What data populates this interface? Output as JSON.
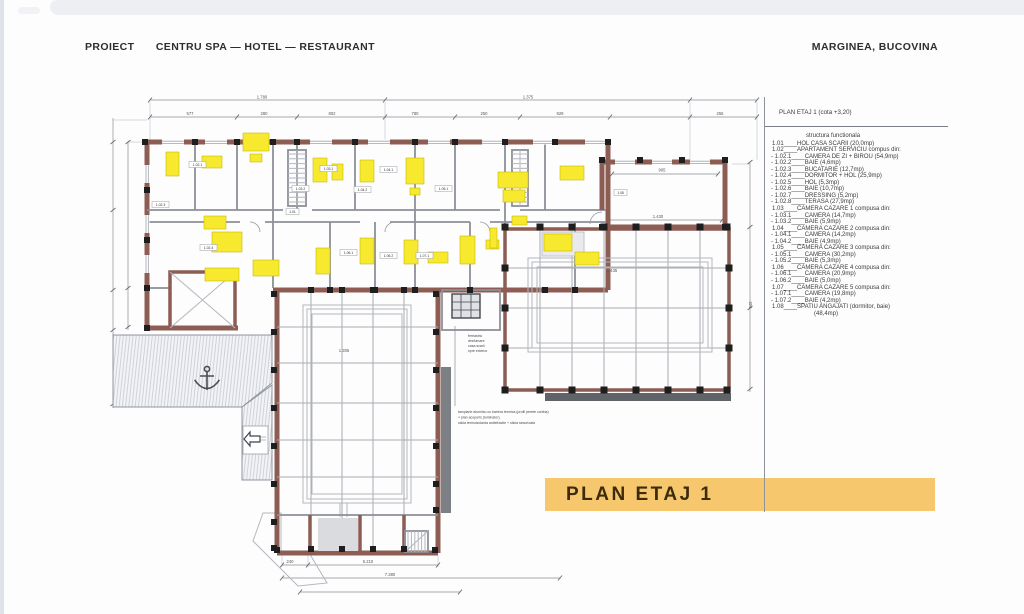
{
  "header": {
    "project_label": "PROIECT",
    "project_title": "CENTRU SPA — HOTEL — RESTAURANT",
    "location": "MARGINEA, BUCOVINA"
  },
  "legend": {
    "title": "PLAN ETAJ 1 (cota +3,20)",
    "subtitle": "structura functionala",
    "items": [
      "1.01____HOL CASA SCARII (20,0mp)",
      "1.02____APARTAMENT SERVICIU compus din:",
      "- 1.02.1____CAMERA DE ZI + BIROU (54,9mp)",
      "- 1.02.2____BAIE (4,6mp)",
      "- 1.02.3____BUCATARIE (12,7mp)",
      "- 1.02.4____DORMITOR + HOL (25,9mp)",
      "- 1.02.5____HOL (5,3mp)",
      "- 1.02.6____BAIE (10,7mp)",
      "- 1.02.7____DRESSING (5,2mp)",
      "- 1.02.8____TERASA (27,9mp)",
      "1.03____CAMERA CAZARE 1 compusa din:",
      "- 1.03.1____CAMERA (14,7mp)",
      "- 1.03.2____BAIE (5,9mp)",
      "1.04____CAMERA CAZARE 2 compusa din:",
      "- 1.04.1____CAMERA (14,2mp)",
      "- 1.04.2____BAIE (4,9mp)",
      "1.05____CAMERA CAZARE 3 compusa din:",
      "- 1.05.1____CAMERA (30,2mp)",
      "- 1.05.2____BAIE (5,3mp)",
      "1.06____CAMERA CAZARE 4 compusa din:",
      "- 1.06.1____CAMERA (20,9mp)",
      "- 1.06.2____BAIE (5,0mp)",
      "1.07____CAMERA CAZARE 5 compusa din:",
      "- 1.07.1____CAMERA (19,8mp)",
      "- 1.07.2____BAIE (4,2mp)",
      "1.08____SPATIU ANGAJATI (dormitor, baie)",
      "(48,4mp)"
    ]
  },
  "banner": {
    "title": "PLAN ETAJ 1",
    "background": "#f6c76d"
  },
  "plan": {
    "dims": {
      "overall_left": "1.780",
      "overall_right": "1.375",
      "segments": [
        "577",
        "280",
        "802",
        "780",
        "250",
        "929",
        "255"
      ],
      "room_108_width": "905",
      "room_108_depth": "1.430",
      "terrace": "1.435",
      "pool": "1.305",
      "bottom": [
        "240",
        "5.210",
        "7.380"
      ],
      "right_side": "945"
    },
    "room_labels": [
      "1.02.1",
      "1.02.3",
      "1.02.4",
      "1.01",
      "1.03.1",
      "1.03.2",
      "1.04.1",
      "1.04.2",
      "1.05.1",
      "1.06.1",
      "1.06.2",
      "1.07.1",
      "1.08"
    ],
    "annotations": {
      "window_note": [
        "fereastra",
        "desfumare",
        "casa scarii",
        "spre exterior"
      ],
      "glazing_note": [
        "tamplarie aluminiu cu bariera termica (profil perete cortina)",
        "+ plan acoperis (luminator),",
        "sticla termoizolanta antiefractie + sticla securizata"
      ]
    }
  },
  "colors": {
    "wall": "#8d5d54",
    "highlight": "#f7e92d",
    "column": "#1e1e1e",
    "banner": "#f6c76d"
  }
}
